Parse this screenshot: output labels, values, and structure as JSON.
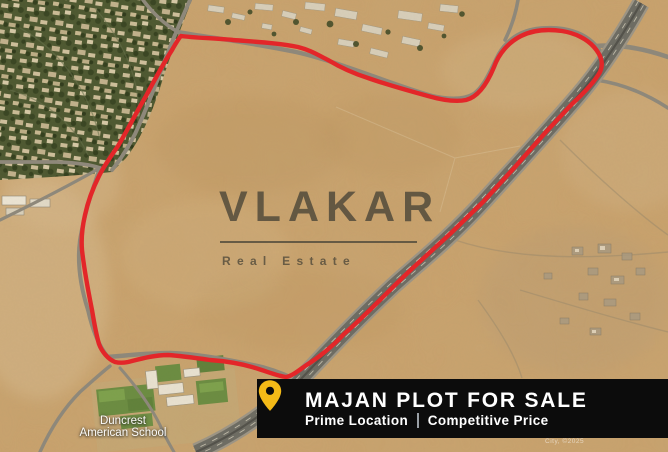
{
  "watermark": {
    "brand": "VLAKAR",
    "tagline": "Real Estate"
  },
  "banner": {
    "title": "MAJAN PLOT FOR SALE",
    "subtitle_left": "Prime Location",
    "subtitle_right": "Competitive Price"
  },
  "map_labels": {
    "school_line1": "Duncrest",
    "school_line2": "American School",
    "attribution": "City, ©2025"
  },
  "icons": {
    "location_pin": "location-pin-icon"
  },
  "colors": {
    "plot_outline": "#e32629",
    "banner_bg": "#0c0c0c",
    "banner_text": "#ffffff",
    "pin_yellow": "#f4ba17",
    "watermark": "#4e4839",
    "desert": "#c9a26c",
    "desert_light": "#d9bd92",
    "residential_green": "#4d5830",
    "field_green": "#6b8c41",
    "road_gray": "#8e887b",
    "highway_asphalt": "#6d6c63"
  }
}
